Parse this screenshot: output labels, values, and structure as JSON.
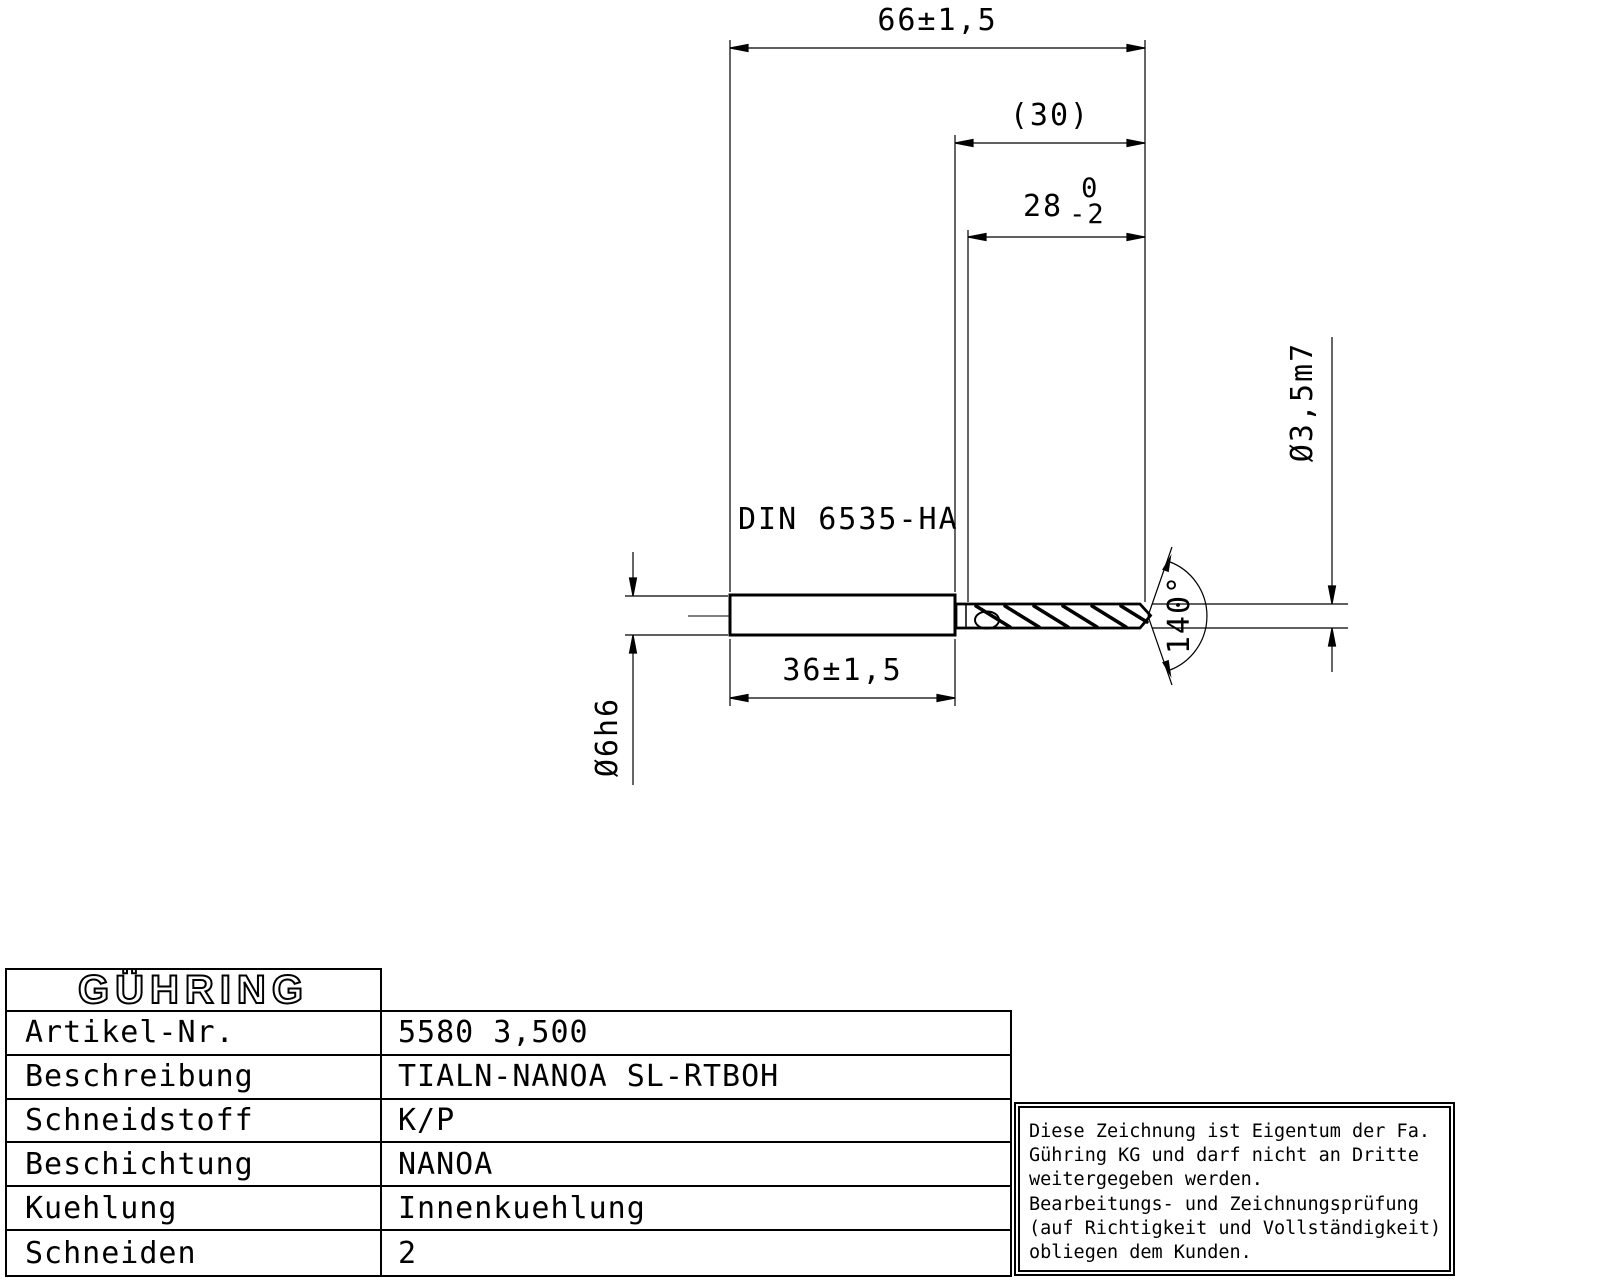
{
  "drawing": {
    "dims": {
      "overall_length": "66±1,5",
      "ref_length": "(30)",
      "flute_length_value": "28",
      "flute_length_tol_upper": "0",
      "flute_length_tol_lower": "-2",
      "shank_standard": "DIN 6535-HA",
      "shank_length": "36±1,5",
      "shank_diameter": "Ø6h6",
      "drill_diameter": "Ø3,5m7",
      "point_angle": "140°"
    }
  },
  "table": {
    "logo": "GÜHRING",
    "rows": [
      {
        "label": "Artikel-Nr.",
        "value": "5580 3,500"
      },
      {
        "label": "Beschreibung",
        "value": "TIALN-NANOA SL-RTBOH"
      },
      {
        "label": "Schneidstoff",
        "value": "K/P"
      },
      {
        "label": "Beschichtung",
        "value": "NANOA"
      },
      {
        "label": "Kuehlung",
        "value": "Innenkuehlung"
      },
      {
        "label": "Schneiden",
        "value": "2"
      }
    ]
  },
  "notice": {
    "lines": [
      "Diese Zeichnung ist Eigentum der Fa.",
      "Gühring KG und darf nicht an Dritte",
      "weitergegeben werden.",
      "Bearbeitungs- und Zeichnungsprüfung",
      "(auf Richtigkeit und Vollständigkeit)",
      "obliegen dem Kunden."
    ]
  }
}
